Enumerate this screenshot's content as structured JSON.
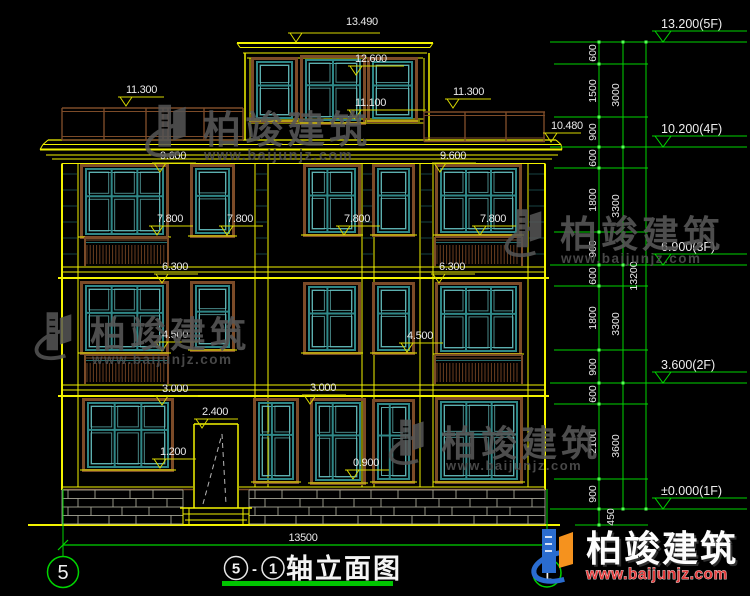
{
  "drawing_title": {
    "axis_bubble_left": "5",
    "axis_bubble_right": "1",
    "circle_start": "5",
    "dash": "-",
    "circle_end": "1",
    "name": "轴立面图"
  },
  "bottom_dimension": {
    "overall_width": "13500"
  },
  "marks": {
    "m13490": "13.490",
    "m12600": "12.600",
    "m11300": "11.300",
    "m11100": "11.100",
    "m10480": "10.480",
    "m9600": "9.600",
    "m7800": "7.800",
    "m6300": "6.300",
    "m4500": "4.500",
    "m3000": "3.000",
    "m2400": "2.400",
    "m1200": "1.200",
    "m0900": "0.900"
  },
  "right_chain": {
    "s600": "600",
    "s1500": "1500",
    "s900": "900",
    "s1800": "1800",
    "s2100": "2100",
    "s450": "450",
    "t3000": "3000",
    "t3300": "3300",
    "t3600": "3600",
    "overall": "13200",
    "levels": {
      "l5f": "13.200(5F)",
      "l4f": "10.200(4F)",
      "l3f": "6.900(3F)",
      "l2f": "3.600(2F)",
      "l1f": "±0.000(1F)"
    }
  },
  "watermark": {
    "brand": "柏竣建筑",
    "url": "www.baijunjz.com"
  },
  "logo": {
    "brand": "柏竣建筑",
    "url": "www.baijunjz.com"
  },
  "colors": {
    "background": "#000000",
    "linework_yellow": "#f2f200",
    "dimension_green": "#00d400",
    "window_teal": "#2f8787",
    "trim_brown": "#7c4b28",
    "text_white": "#eaeaea",
    "brand_blue": "#2a6cd0",
    "brand_orange": "#f5921e",
    "brand_red": "#e23c3c"
  }
}
